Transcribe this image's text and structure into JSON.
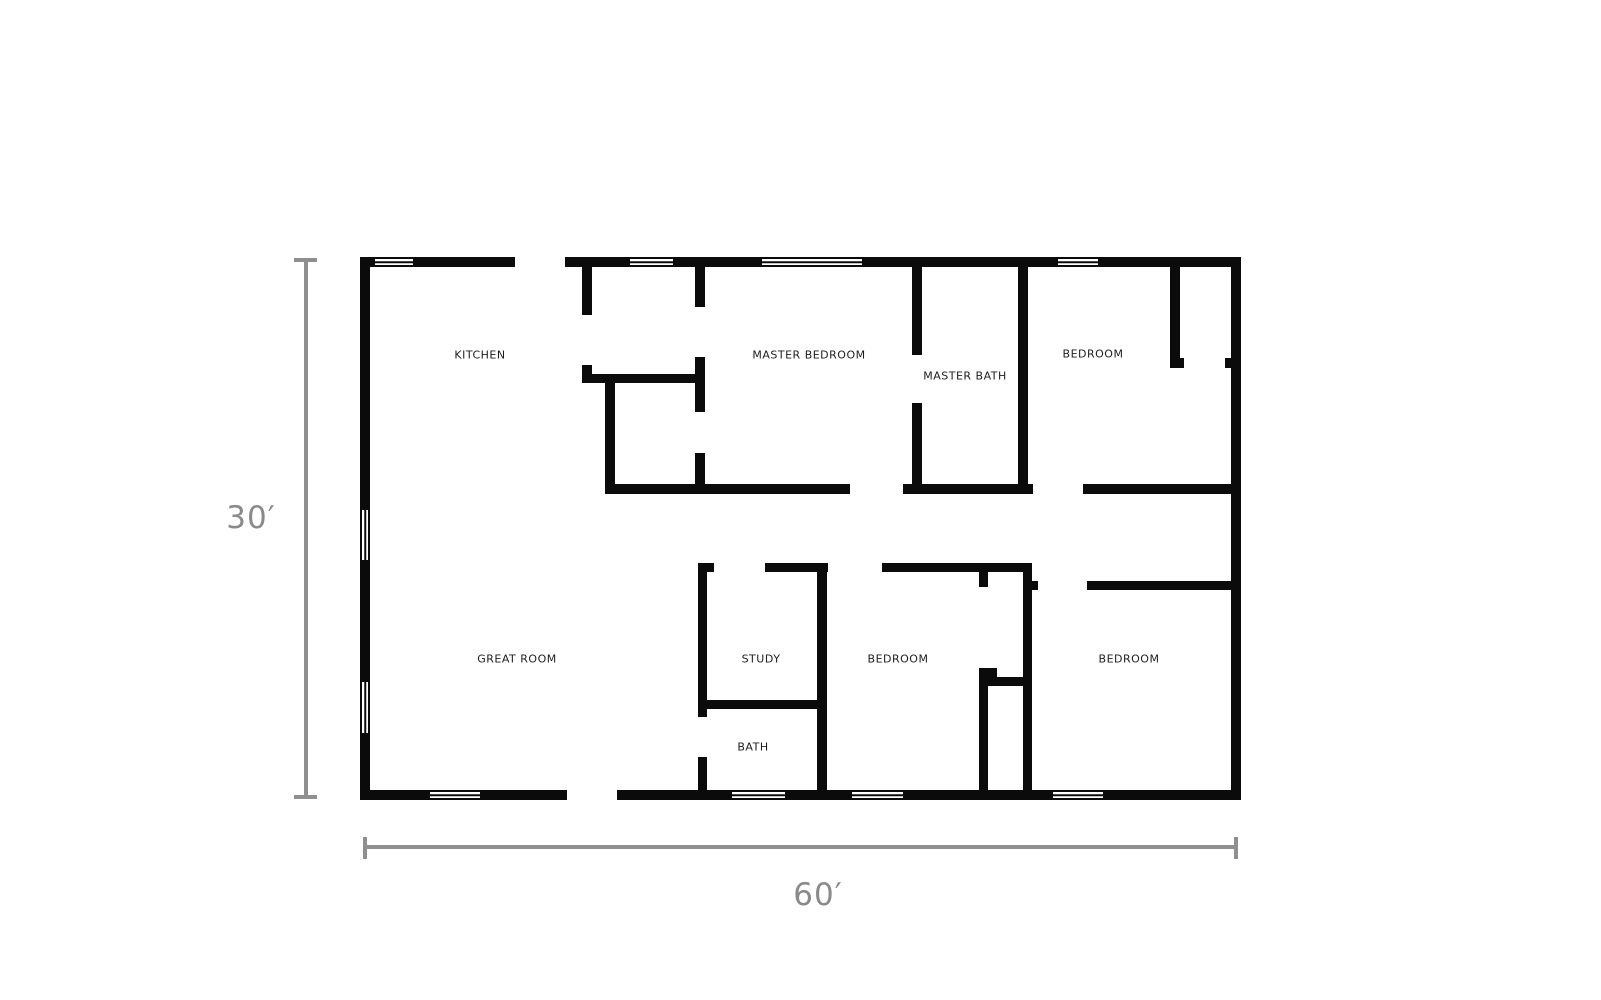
{
  "page": {
    "width": 1601,
    "height": 1000,
    "background": "#ffffff"
  },
  "style": {
    "wall_color": "#0b0b0b",
    "label_color": "#1d1d1d",
    "dim_color": "#8f8f8f",
    "dim_text_color": "#8a8a8a",
    "window_fill": "#ffffff",
    "page_bg": "#ffffff"
  },
  "rooms": [
    {
      "name": "KITCHEN",
      "cx": 480,
      "cy": 355
    },
    {
      "name": "MASTER BEDROOM",
      "cx": 809,
      "cy": 355
    },
    {
      "name": "MASTER BATH",
      "cx": 965,
      "cy": 376
    },
    {
      "name": "BEDROOM",
      "cx": 1093,
      "cy": 354
    },
    {
      "name": "GREAT ROOM",
      "cx": 517,
      "cy": 659
    },
    {
      "name": "STUDY",
      "cx": 761,
      "cy": 659
    },
    {
      "name": "BEDROOM",
      "cx": 898,
      "cy": 659
    },
    {
      "name": "BEDROOM",
      "cx": 1129,
      "cy": 659
    },
    {
      "name": "BATH",
      "cx": 753,
      "cy": 747
    }
  ],
  "walls": [
    [
      360,
      257,
      15,
      10
    ],
    [
      413,
      257,
      102,
      10
    ],
    [
      565,
      257,
      65,
      10
    ],
    [
      673,
      257,
      89,
      10
    ],
    [
      862,
      257,
      196,
      10
    ],
    [
      1098,
      257,
      143,
      10
    ],
    [
      360,
      257,
      10,
      253
    ],
    [
      360,
      560,
      10,
      122
    ],
    [
      360,
      733,
      10,
      67
    ],
    [
      1231,
      257,
      10,
      543
    ],
    [
      360,
      790,
      70,
      10
    ],
    [
      480,
      790,
      87,
      10
    ],
    [
      617,
      790,
      115,
      10
    ],
    [
      785,
      790,
      67,
      10
    ],
    [
      903,
      790,
      150,
      10
    ],
    [
      1103,
      790,
      138,
      10
    ],
    [
      582,
      267,
      10,
      48
    ],
    [
      695,
      267,
      10,
      40
    ],
    [
      695,
      357,
      10,
      55
    ],
    [
      695,
      453,
      10,
      41
    ],
    [
      582,
      365,
      10,
      9
    ],
    [
      582,
      374,
      123,
      9
    ],
    [
      605,
      383,
      10,
      101
    ],
    [
      605,
      484,
      245,
      10
    ],
    [
      903,
      484,
      130,
      10
    ],
    [
      1083,
      484,
      158,
      10
    ],
    [
      912,
      267,
      10,
      88
    ],
    [
      912,
      403,
      10,
      91
    ],
    [
      1018,
      267,
      10,
      227
    ],
    [
      1170,
      267,
      10,
      91
    ],
    [
      1170,
      358,
      14,
      10
    ],
    [
      1225,
      358,
      6,
      10
    ],
    [
      698,
      563,
      16,
      9
    ],
    [
      765,
      563,
      63,
      9
    ],
    [
      882,
      563,
      150,
      9
    ],
    [
      1032,
      581,
      6,
      9
    ],
    [
      1087,
      581,
      154,
      9
    ],
    [
      698,
      563,
      9,
      154
    ],
    [
      698,
      757,
      9,
      33
    ],
    [
      817,
      563,
      10,
      227
    ],
    [
      706,
      700,
      111,
      9
    ],
    [
      979,
      572,
      9,
      15
    ],
    [
      979,
      668,
      18,
      9
    ],
    [
      988,
      677,
      35,
      9
    ],
    [
      979,
      668,
      9,
      122
    ],
    [
      1023,
      563,
      9,
      227
    ]
  ],
  "windows": [
    {
      "rect": [
        375,
        257,
        38,
        10
      ],
      "orientation": "h"
    },
    {
      "rect": [
        630,
        257,
        43,
        10
      ],
      "orientation": "h"
    },
    {
      "rect": [
        762,
        257,
        100,
        10
      ],
      "orientation": "h"
    },
    {
      "rect": [
        1058,
        257,
        40,
        10
      ],
      "orientation": "h"
    },
    {
      "rect": [
        430,
        790,
        50,
        10
      ],
      "orientation": "h"
    },
    {
      "rect": [
        732,
        790,
        53,
        10
      ],
      "orientation": "h"
    },
    {
      "rect": [
        852,
        790,
        51,
        10
      ],
      "orientation": "h"
    },
    {
      "rect": [
        1053,
        790,
        50,
        10
      ],
      "orientation": "h"
    },
    {
      "rect": [
        360,
        510,
        10,
        50
      ],
      "orientation": "v"
    },
    {
      "rect": [
        360,
        682,
        10,
        51
      ],
      "orientation": "v"
    }
  ],
  "dimensions": {
    "height": {
      "label": {
        "text": "30′",
        "cx": 251,
        "cy": 518
      },
      "line": [
        304,
        258,
        4,
        541
      ],
      "cap_start": [
        294,
        258,
        23,
        4
      ],
      "cap_end": [
        294,
        795,
        23,
        4
      ]
    },
    "width": {
      "label": {
        "text": "60′",
        "cx": 818,
        "cy": 895
      },
      "line": [
        367,
        845,
        869,
        4
      ],
      "cap_start": [
        363,
        837,
        4,
        22
      ],
      "cap_end": [
        1234,
        837,
        4,
        22
      ]
    }
  }
}
